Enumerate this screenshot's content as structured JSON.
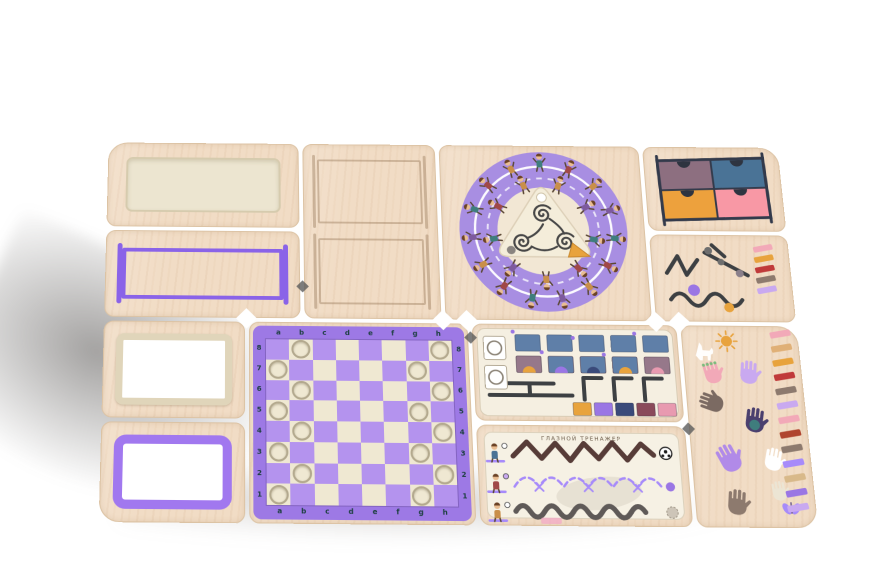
{
  "scene": {
    "description": "Wooden children's busy-board activity panel set, perspective product photo on white background"
  },
  "palette": {
    "wood": "#f1dcc5",
    "woodEdge": "#dcc3a4",
    "cream": "#ece5d0",
    "creamDark": "#d6cbae",
    "creamFrame": "#e0d5ba",
    "white": "#ffffff",
    "purple": "#9d79e5",
    "purpleDeep": "#8a63e8",
    "purpleFrame": "#a178ef",
    "ink": "#3d4043",
    "coord": "#1c3f3f",
    "chessBorder": "#9d79e5",
    "chessLight": "#efe8d2",
    "chessDark": "#b493ee",
    "doorFrame": "#333a4b",
    "notch": "#2e3440",
    "zigzag": "#573c38",
    "wave": "#5f5a58",
    "dash": "#a78bfa",
    "shadow": "rgba(78,75,73,0.52)"
  },
  "panels": {
    "blank_insert": {
      "label": "blank insert board"
    },
    "goal_frame": {
      "frame_color": "#8a63e8"
    },
    "engraved_frames": {
      "count": 2
    },
    "ring_game": {
      "ring_color": "#a88ee2",
      "center_fill": "#f4edda",
      "maze_color": "#474747",
      "track_color": "#ffffff",
      "start_dot": "#8a8580",
      "end_marker": "#e8a33d",
      "outer_kids": 15,
      "inner_kids": 9,
      "shirt_colors": [
        "#3f7d7d",
        "#a04848",
        "#c98f4a",
        "#7d5a9e"
      ],
      "skin": "#e9bd92",
      "hair": "#6b4226"
    },
    "doors": {
      "colors": [
        "#8d6f80",
        "#4a7396",
        "#eda13d",
        "#f898a5"
      ]
    },
    "bead_paths": {
      "bead_colors": [
        "#9a76e4",
        "#e8a33d",
        "#6e6e6e",
        "#8a7f8a"
      ],
      "stripes": [
        "#f2a9b8",
        "#e8a33d",
        "#c03a3a",
        "#8d7a6e",
        "#c9a9f0"
      ]
    },
    "chess": {
      "files": [
        "a",
        "b",
        "c",
        "d",
        "e",
        "f",
        "g",
        "h"
      ],
      "ranks": [
        "8",
        "7",
        "6",
        "5",
        "4",
        "3",
        "2",
        "1"
      ],
      "holes": [
        "b8",
        "h8",
        "a7",
        "g7",
        "b6",
        "h6",
        "a5",
        "g5",
        "b4",
        "h4",
        "a3",
        "g3",
        "b2",
        "h2",
        "a1",
        "g1"
      ]
    },
    "matching_cards": {
      "top_row": [
        "#5f7fa8",
        "#5f7fa8",
        "#5f7fa8",
        "#5f7fa8",
        "#5f7fa8"
      ],
      "mid_row": [
        "#96788a",
        "#5f7fa8",
        "#5f7fa8",
        "#5f7fa8",
        "#96788a"
      ],
      "bottom_row": [
        "#e8a33d",
        "#9a76e4",
        "#3a4a7a",
        "#8a4a5a",
        "#e89ab0"
      ],
      "bump_colors": [
        "#e8a33d",
        "#9a76e4",
        "#3a4a7a",
        "#e8a33d",
        "#e89ab0"
      ]
    },
    "eye_trainer": {
      "title": "ГЛАЗНОЙ ТРЕНАЖЕР",
      "track_count": 3
    },
    "handprints": {
      "colors": [
        "#f2a9b8",
        "#c9a9f0",
        "#7b6a62",
        "#4a3f6e",
        "#b18ae8",
        "#ffffff",
        "#8d7a6e",
        "#ece5d4"
      ],
      "finger_accent": "#7dbb7d",
      "palm_accent": "#3f7d7d",
      "sun_color": "#e8a33d",
      "butterfly_color": "#a78bfa",
      "stripes": [
        "#f2a9b8",
        "#e0b077",
        "#e8a33d",
        "#c03a3a",
        "#8d7a6e",
        "#c9a9f0",
        "#f2a9b8",
        "#b0452f",
        "#8d7a6e",
        "#a78bfa",
        "#d8b98a",
        "#9a76e4",
        "#c9a9f0"
      ]
    }
  }
}
